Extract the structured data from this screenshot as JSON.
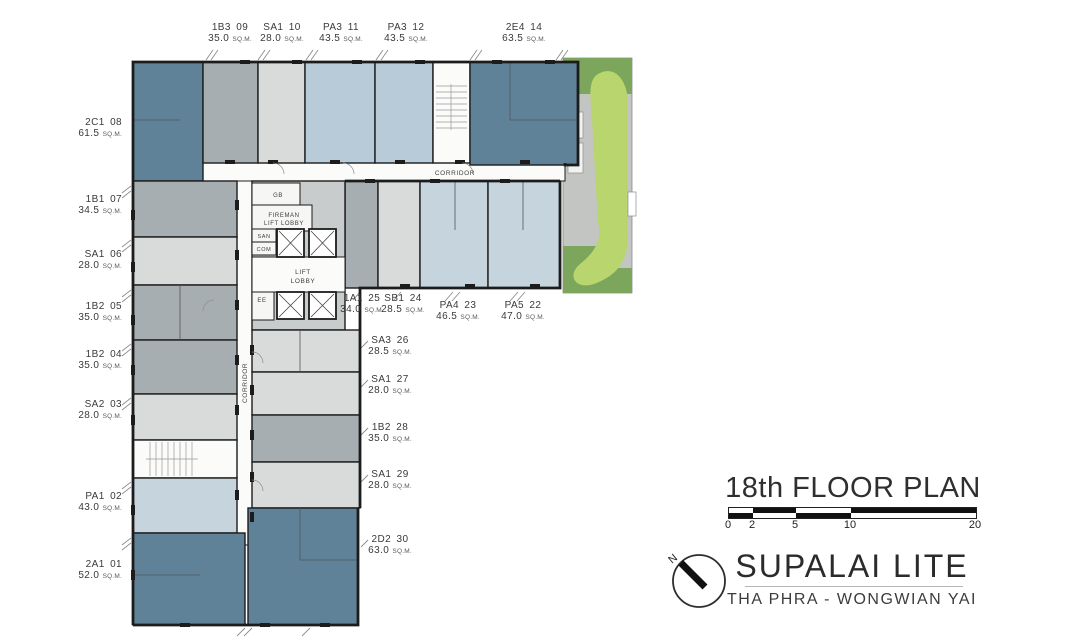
{
  "colors": {
    "unit_dark": "#5f8299",
    "unit_midgray": "#a7aeb1",
    "unit_lightgray": "#d9dbda",
    "unit_lightblue": "#b7cbd8",
    "unit_paleblue": "#c5d4dd",
    "core_gray": "#c9cccc",
    "wall": "#1c1c1c",
    "lawn_green": "#b9d56d",
    "shrub_green": "#7ca65b",
    "path_gray": "#c2c5c1"
  },
  "plan": {
    "corridor_h": "CORRIDOR",
    "corridor_v": "CORRIDOR",
    "area_suffix": "SQ.M.",
    "core": {
      "gb": "GB",
      "fireman_line1": "FIREMAN",
      "fireman_line2": "LIFT LOBBY",
      "san": "SAN",
      "com": "COM",
      "lift_line1": "LIFT",
      "lift_line2": "LOBBY",
      "ee": "EE"
    },
    "units": [
      {
        "code": "1B3",
        "no": "09",
        "area": "35.0"
      },
      {
        "code": "SA1",
        "no": "10",
        "area": "28.0"
      },
      {
        "code": "PA3",
        "no": "11",
        "area": "43.5"
      },
      {
        "code": "PA3",
        "no": "12",
        "area": "43.5"
      },
      {
        "code": "2E4",
        "no": "14",
        "area": "63.5"
      },
      {
        "code": "2C1",
        "no": "08",
        "area": "61.5"
      },
      {
        "code": "1B1",
        "no": "07",
        "area": "34.5"
      },
      {
        "code": "SA1",
        "no": "06",
        "area": "28.0"
      },
      {
        "code": "1B2",
        "no": "05",
        "area": "35.0"
      },
      {
        "code": "1B2",
        "no": "04",
        "area": "35.0"
      },
      {
        "code": "SA2",
        "no": "03",
        "area": "28.0"
      },
      {
        "code": "PA1",
        "no": "02",
        "area": "43.0"
      },
      {
        "code": "2A1",
        "no": "01",
        "area": "52.0"
      },
      {
        "code": "1A1",
        "no": "25",
        "area": "34.0"
      },
      {
        "code": "SB1",
        "no": "24",
        "area": "28.5"
      },
      {
        "code": "PA4",
        "no": "23",
        "area": "46.5"
      },
      {
        "code": "PA5",
        "no": "22",
        "area": "47.0"
      },
      {
        "code": "SA3",
        "no": "26",
        "area": "28.5"
      },
      {
        "code": "SA1",
        "no": "27",
        "area": "28.0"
      },
      {
        "code": "1B2",
        "no": "28",
        "area": "35.0"
      },
      {
        "code": "SA1",
        "no": "29",
        "area": "28.0"
      },
      {
        "code": "2D2",
        "no": "30",
        "area": "63.0"
      }
    ]
  },
  "title_block": {
    "title": "18th FLOOR PLAN",
    "scale_ticks": [
      "0",
      "2",
      "5",
      "10",
      "20"
    ],
    "north": "N",
    "brand": "SUPALAI LITE",
    "subtitle": "THA PHRA - WONGWIAN YAI"
  }
}
